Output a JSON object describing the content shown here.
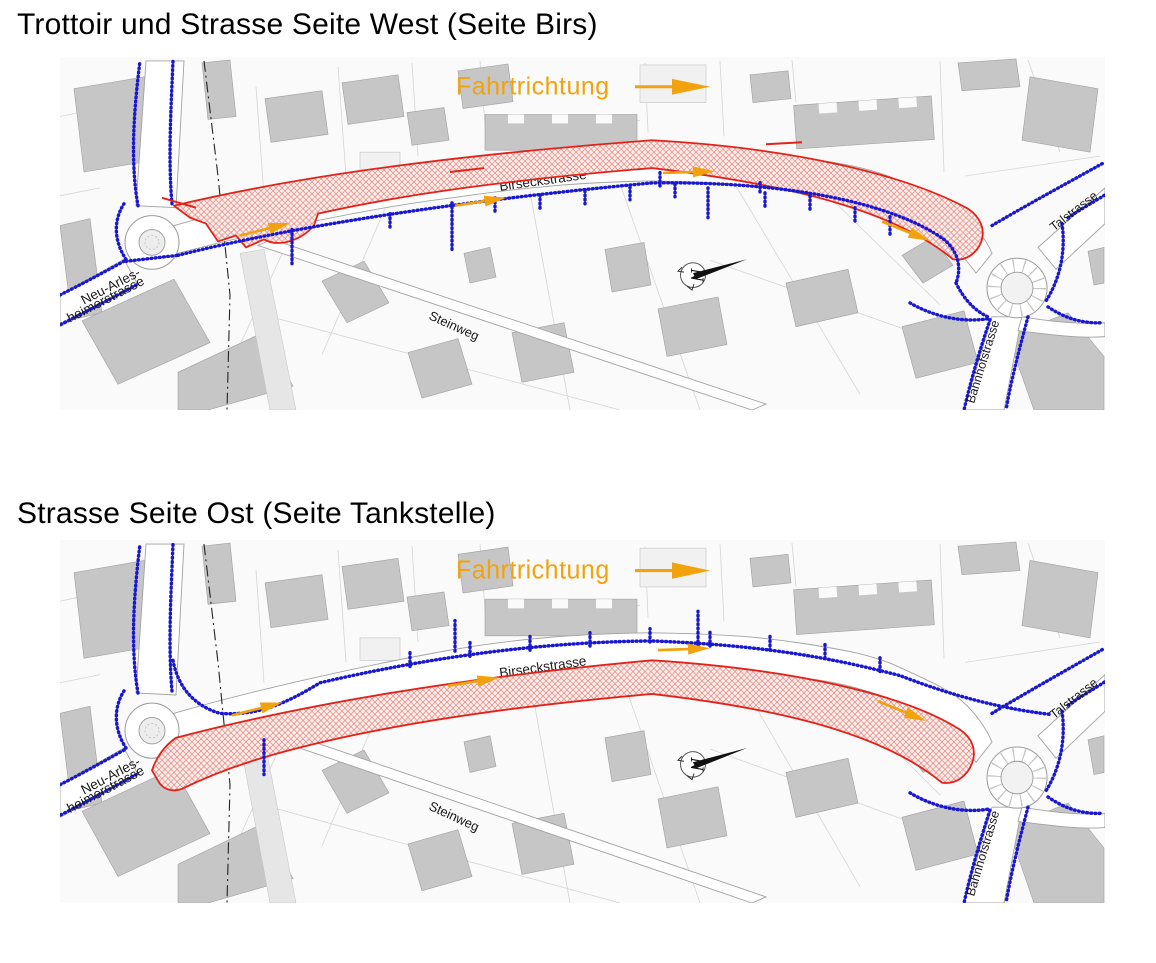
{
  "sections": [
    {
      "title": "Trottoir und Strasse Seite West (Seite Birs)",
      "zone": "west"
    },
    {
      "title": "Strasse Seite Ost (Seite Tankstelle)",
      "zone": "ost"
    }
  ],
  "map": {
    "direction_label": "Fahrtrichtung",
    "labels": {
      "main_street": "Birseckstrasse",
      "steinweg": "Steinweg",
      "talstrasse": "Talstrasse",
      "bahnhofstrasse": "Bahnhofstrasse",
      "neu_arlesheimer_line1": "Neu-Arles-",
      "neu_arlesheimer_line2": "heimerstrasse",
      "north_symbol": "N"
    },
    "colors": {
      "construction_zone_red": "#e2231a",
      "pedestrian_route_blue": "#1a18cf",
      "direction_orange": "#f1a20c",
      "building_gray": "#c6c6c6"
    }
  }
}
